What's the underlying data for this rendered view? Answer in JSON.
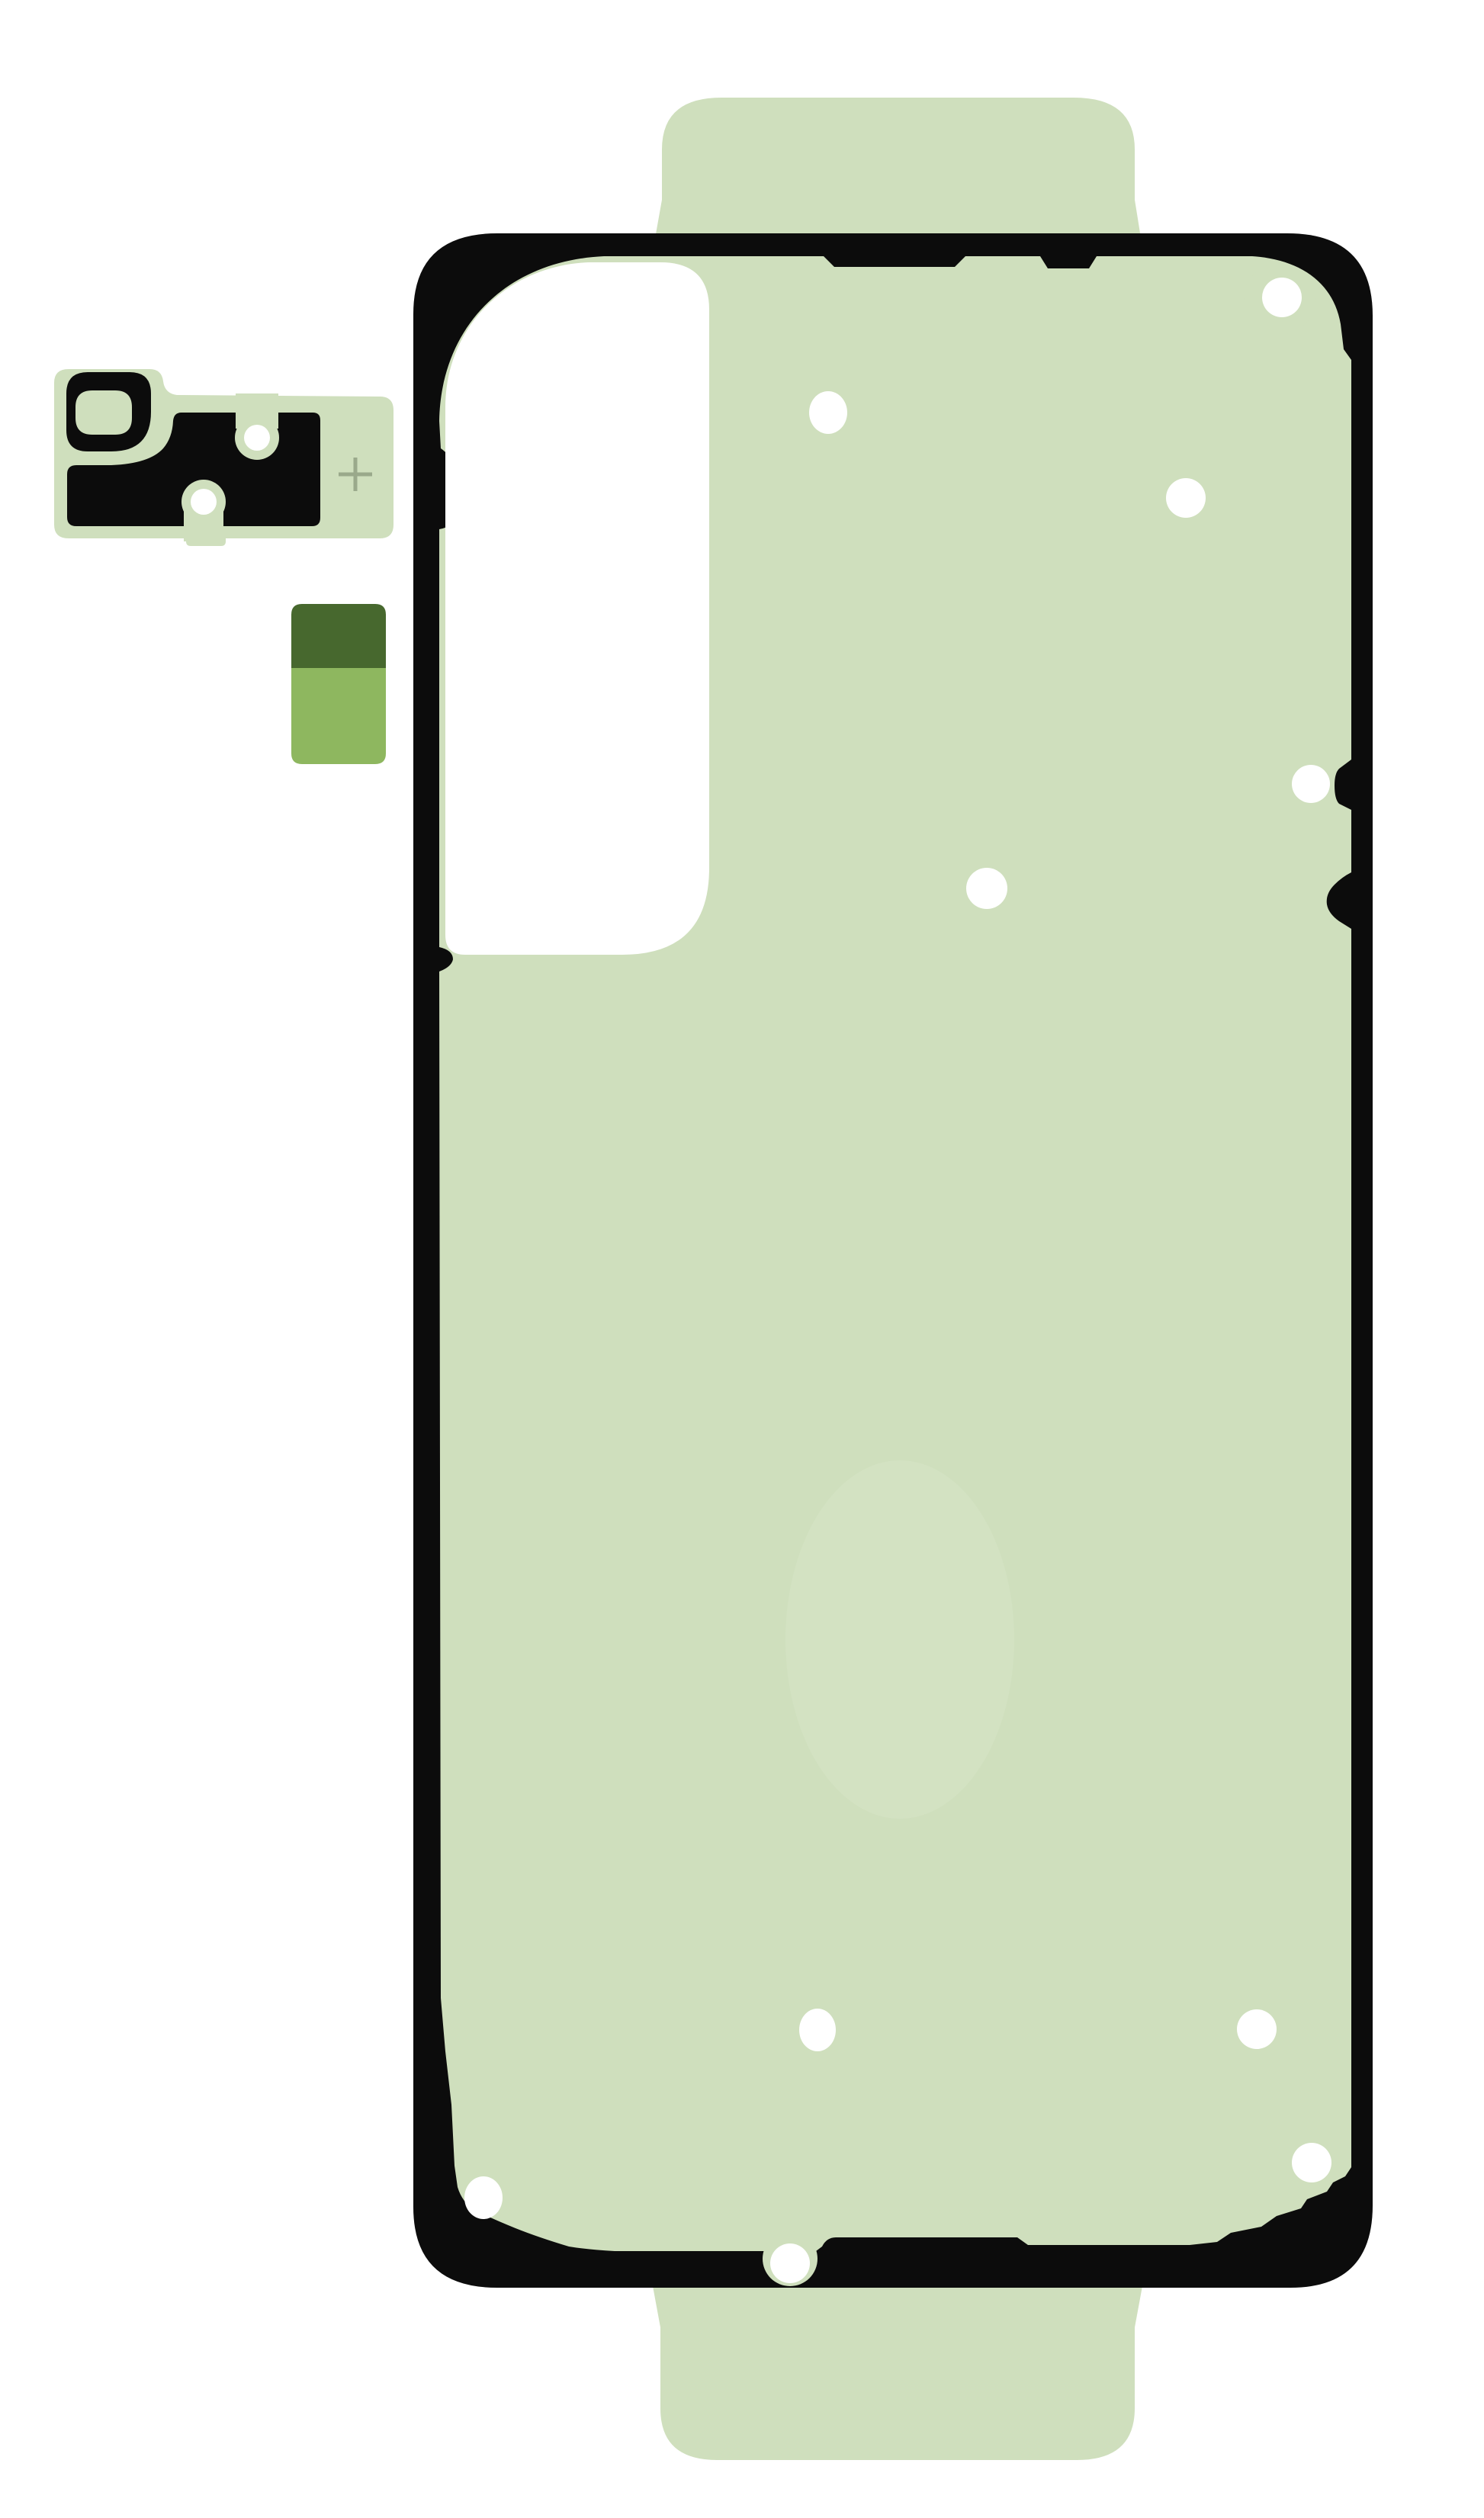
{
  "image": {
    "kind": "product-photo",
    "subject": "smartphone-back-cover-adhesive-set",
    "background": "#ffffff"
  },
  "colors": {
    "page_bg": "#ffffff",
    "sheet_green": "#cfdfbd",
    "outline_black": "#0c0c0c",
    "hole_white": "#ffffff",
    "cutout_white": "#ffffff",
    "backing_green": "#cfdfbd",
    "square_dark_green": "#47682e",
    "square_mid_green": "#8eb75f",
    "cross_gray_green": "#9aa98b",
    "watermark_tint": "#d8e5c8"
  },
  "pieces": {
    "main_sheet": {
      "name": "back-cover-adhesive-sheet",
      "alignment_hole_count": 10,
      "has_camera_cutout": true,
      "pull_tab_count": 2
    },
    "camera_piece": {
      "name": "camera-bezel-adhesive",
      "screw_hole_count": 2,
      "has_registration_cross": true
    },
    "spare_squares": {
      "name": "spare-adhesive-squares",
      "count": 2
    }
  }
}
